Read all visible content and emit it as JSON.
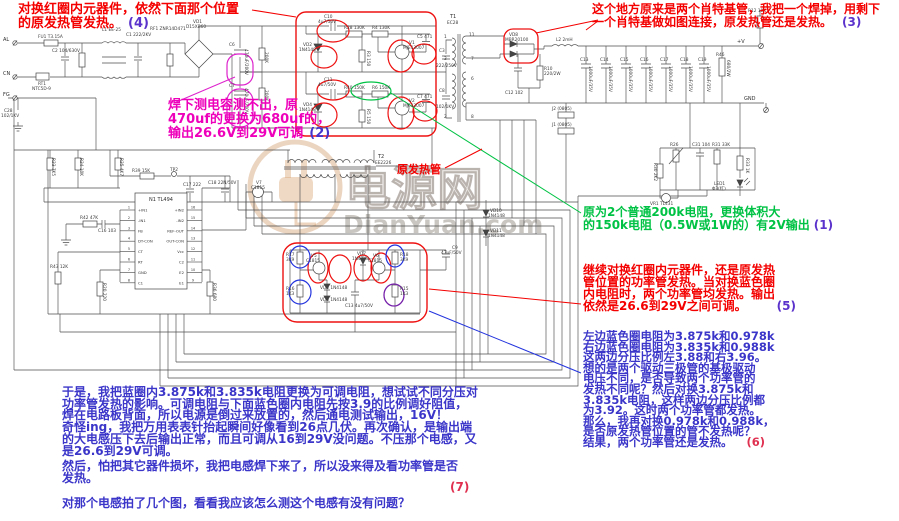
{
  "watermark": {
    "cn": "电源网",
    "en": "DianYuan.com"
  },
  "colors": {
    "annotation_red": "#f40000",
    "annotation_magenta": "#ee00bb",
    "annotation_green": "#00c244",
    "annotation_blue": "#3b36c9",
    "number_violet": "#5b33cc",
    "number_red": "#e03050",
    "highlight_red": "#ee1111",
    "highlight_magenta": "#dd22cc",
    "highlight_green": "#00c244",
    "highlight_blue": "#2233dd",
    "highlight_purple": "#7722aa"
  },
  "annotations": [
    {
      "id": "annotation-4",
      "x": 18,
      "y": 3,
      "c": "#f40000",
      "fs": 13,
      "lh": 13.5,
      "lines": [
        "对换红圈内元器件，依然下面那个位置",
        "的原发热管发热。"
      ],
      "num": "(4)",
      "nc": "#5b33cc",
      "gap": 6
    },
    {
      "id": "annotation-3",
      "x": 592,
      "y": 3,
      "c": "#f40000",
      "fs": 12,
      "lh": 13,
      "lines": [
        "这个地方原来是两个肖特基管，我把一个焊掉，用剩下",
        "一个肖特基做如图连接，原发热管还是发热。"
      ],
      "num": "(3)",
      "nc": "#5b33cc",
      "gap": 10
    },
    {
      "id": "annotation-2",
      "x": 168,
      "y": 99,
      "c": "#ee00bb",
      "fs": 13,
      "lh": 14,
      "lines": [
        "焊下测电容测不出，原",
        "470uf的更换为680uf的，",
        "输出26.6V到29V可调"
      ],
      "num": "(2)",
      "nc": "#4433cc",
      "gap": 6
    },
    {
      "id": "annotation-1",
      "x": 583,
      "y": 206,
      "c": "#00c244",
      "fs": 12,
      "lh": 12.5,
      "lines": [
        "原为2个普通200k电阻，更换体积大",
        "的150k电阻（0.5W或1W的）有2V输出"
      ],
      "num": "(1)",
      "nc": "#5b33cc",
      "gap": 4
    },
    {
      "id": "annotation-5",
      "x": 583,
      "y": 264,
      "c": "#f40000",
      "fs": 12,
      "lh": 12,
      "lines": [
        "继续对换红圈内元器件，还是原发热",
        "管位置的功率管发热。当对换蓝色圈",
        "内电阻时，两个功率管均发热。输出",
        "依然是26.6到29V之间可调。"
      ],
      "num": "(5)",
      "nc": "#5b33cc",
      "gap": 30
    },
    {
      "id": "annotation-6",
      "x": 583,
      "y": 331,
      "c": "#3b36c9",
      "fs": 11.5,
      "lh": 10.6,
      "lines": [
        "左边蓝色圈电阻为3.875k和0.978k",
        "右边蓝色圈电阻为3.835k和0.988k",
        "这两边分压比例左3.88和右3.96。",
        "想的是两个驱动三极管的基极驱动",
        "电压不同，是否导致两个功率管的",
        "发热不同呢？然后对换3.875k和",
        "3.835k电阻，这样两边分压比例都",
        "为3.92。这时两个功率管都发热。",
        "那么，我再对换0.978k和0.988k，",
        "是否原发热管位置的管不发热呢？",
        "结果，两个功率管还是发热。"
      ],
      "num": "(6)",
      "nc": "#e03050",
      "gap": 14
    },
    {
      "id": "annotation-hot-tube",
      "x": 397,
      "y": 164,
      "c": "#f40000",
      "fs": 11,
      "lh": 11,
      "lines": [
        "原发热管"
      ]
    },
    {
      "id": "annotation-story",
      "x": 62,
      "y": 387,
      "c": "#3b36c9",
      "fs": 12,
      "lh": 11.7,
      "l****ines": [],
      "lines": [
        "于是，我把蓝圈内3.875k和3.835k电阻更换为可调电阻，想试试不同分压对",
        "功率管发热的影响。可调电阻与下面蓝色圈内电阻先按3.9的比例调好阻值，",
        "焊在电路板背面，所以电源是倒过来放置的，然后通电测试输出，16V！",
        "奇怪ing，我把万用表表针抬起瞬间好像看到26点几伏。再次确认，是输出端",
        "的大电感压下去后输出正常，而且可调从16到29V没问题。不压那个电感，又",
        "是26.6到29V可调。"
      ]
    },
    {
      "id": "annotation-then",
      "x": 62,
      "y": 461,
      "c": "#3b36c9",
      "fs": 12,
      "lh": 11.7,
      "lines": [
        "然后，怕把其它器件损坏，我把电感焊下来了，所以没来得及看功率管是否",
        "发热。"
      ]
    },
    {
      "id": "annotation-7-number",
      "x": 450,
      "y": 481,
      "c": "#e03050",
      "fs": 12,
      "lh": 12,
      "lines": [
        "(7)"
      ]
    },
    {
      "id": "annotation-question",
      "x": 62,
      "y": 497,
      "c": "#3b36c9",
      "fs": 12,
      "lh": 12,
      "lines": [
        "对那个电感拍了几个图，看看我应该怎么测这个电感有没有问题？"
      ]
    }
  ],
  "ic": {
    "name": "N1",
    "part": "TL494",
    "pins_left": [
      {
        "n": "1",
        "label": "+IN1"
      },
      {
        "n": "2",
        "label": "-IN1"
      },
      {
        "n": "3",
        "label": "FB"
      },
      {
        "n": "4",
        "label": "DT-CON"
      },
      {
        "n": "5",
        "label": "CT"
      },
      {
        "n": "6",
        "label": "RT"
      },
      {
        "n": "7",
        "label": "GND"
      },
      {
        "n": "8",
        "label": "C1"
      }
    ],
    "pins_right": [
      {
        "n": "16",
        "label": "+IN2"
      },
      {
        "n": "15",
        "label": "-IN2"
      },
      {
        "n": "14",
        "label": "REF-OUT"
      },
      {
        "n": "13",
        "label": "OUT-CON"
      },
      {
        "n": "12",
        "label": "Vcc"
      },
      {
        "n": "11",
        "label": "C2"
      },
      {
        "n": "10",
        "label": "E2"
      },
      {
        "n": "9",
        "label": "E1"
      }
    ]
  },
  "schematic_labels": [
    {
      "t": "AL",
      "x": 3,
      "y": 41,
      "s": "b"
    },
    {
      "t": "CN",
      "x": 3,
      "y": 75,
      "s": "b"
    },
    {
      "t": "FG",
      "x": 3,
      "y": 96,
      "s": "b"
    },
    {
      "t": "FU1 T3.15A",
      "x": 38,
      "y": 38
    },
    {
      "t": "L1 EE-25",
      "x": 102,
      "y": 31
    },
    {
      "t": "C1 222/2KV",
      "x": 126,
      "y": 36
    },
    {
      "t": "RF1 ZNR14D471",
      "x": 150,
      "y": 30
    },
    {
      "t": "VD1",
      "x": 193,
      "y": 23
    },
    {
      "t": "D15XB60",
      "x": 186,
      "y": 28
    },
    {
      "t": "RT1",
      "x": 38,
      "y": 85
    },
    {
      "t": "NTC5D-9",
      "x": 32,
      "y": 90
    },
    {
      "t": "C2 104/630V",
      "x": 52,
      "y": 52
    },
    {
      "t": "C28",
      "x": 4,
      "y": 112
    },
    {
      "t": "102/1KV",
      "x": 1,
      "y": 117
    },
    {
      "t": "C6",
      "x": 229,
      "y": 46
    },
    {
      "t": "470uF/200V",
      "x": 245,
      "y": 49,
      "r": 90
    },
    {
      "t": "C7",
      "x": 229,
      "y": 87
    },
    {
      "t": "470uF/200V",
      "x": 245,
      "y": 88,
      "r": 90
    },
    {
      "t": "200K",
      "x": 265,
      "y": 52,
      "r": 90
    },
    {
      "t": "200K",
      "x": 265,
      "y": 90,
      "r": 90
    },
    {
      "t": "C10",
      "x": 324,
      "y": 18
    },
    {
      "t": "4u7/50V",
      "x": 318,
      "y": 23
    },
    {
      "t": "R28 130K",
      "x": 344,
      "y": 29
    },
    {
      "t": "R4 130K",
      "x": 372,
      "y": 29
    },
    {
      "t": "VD2",
      "x": 303,
      "y": 46
    },
    {
      "t": "1N4148",
      "x": 299,
      "y": 51
    },
    {
      "t": "R3 150",
      "x": 367,
      "y": 51,
      "r": 90
    },
    {
      "t": "V1",
      "x": 409,
      "y": 44
    },
    {
      "t": "MJE13007",
      "x": 403,
      "y": 49
    },
    {
      "t": "C5 471",
      "x": 417,
      "y": 38
    },
    {
      "t": "C11",
      "x": 324,
      "y": 81
    },
    {
      "t": "4u7/50V",
      "x": 318,
      "y": 86
    },
    {
      "t": "R40 150K",
      "x": 344,
      "y": 89
    },
    {
      "t": "R6 150K",
      "x": 372,
      "y": 89
    },
    {
      "t": "VD4",
      "x": 303,
      "y": 106
    },
    {
      "t": "1N4148",
      "x": 299,
      "y": 111
    },
    {
      "t": "R5 150",
      "x": 367,
      "y": 109,
      "r": 90
    },
    {
      "t": "V2",
      "x": 409,
      "y": 102
    },
    {
      "t": "MJE13007",
      "x": 403,
      "y": 107
    },
    {
      "t": "C7 471",
      "x": 417,
      "y": 98
    },
    {
      "t": "C3",
      "x": 439,
      "y": 52
    },
    {
      "t": "222/250V",
      "x": 436,
      "y": 67
    },
    {
      "t": "C8",
      "x": 439,
      "y": 92
    },
    {
      "t": "102/1KV",
      "x": 436,
      "y": 108
    },
    {
      "t": "T1",
      "x": 450,
      "y": 18,
      "s": "b"
    },
    {
      "t": "EC28",
      "x": 447,
      "y": 24
    },
    {
      "t": "1",
      "x": 444,
      "y": 38
    },
    {
      "t": "3",
      "x": 444,
      "y": 60
    },
    {
      "t": "2",
      "x": 444,
      "y": 118
    },
    {
      "t": "11",
      "x": 469,
      "y": 36
    },
    {
      "t": "7",
      "x": 471,
      "y": 60
    },
    {
      "t": "6",
      "x": 471,
      "y": 80
    },
    {
      "t": "8",
      "x": 471,
      "y": 118
    },
    {
      "t": "VD8",
      "x": 509,
      "y": 36
    },
    {
      "t": "MBR20100",
      "x": 505,
      "y": 41
    },
    {
      "t": "L2 2mH",
      "x": 556,
      "y": 41
    },
    {
      "t": "C12 102",
      "x": 505,
      "y": 94
    },
    {
      "t": "R10",
      "x": 544,
      "y": 70
    },
    {
      "t": "220/2W",
      "x": 544,
      "y": 75
    },
    {
      "t": "C13",
      "x": 580,
      "y": 61
    },
    {
      "t": "1000uF/35V",
      "x": 589,
      "y": 66,
      "r": 90
    },
    {
      "t": "C14",
      "x": 600,
      "y": 61
    },
    {
      "t": "1000uF/35V",
      "x": 609,
      "y": 66,
      "r": 90
    },
    {
      "t": "C15",
      "x": 620,
      "y": 61
    },
    {
      "t": "1000uF/35V",
      "x": 629,
      "y": 66,
      "r": 90
    },
    {
      "t": "C16",
      "x": 640,
      "y": 61
    },
    {
      "t": "1000uF/35V",
      "x": 649,
      "y": 66,
      "r": 90
    },
    {
      "t": "C17",
      "x": 660,
      "y": 61
    },
    {
      "t": "1000uF/35V",
      "x": 669,
      "y": 66,
      "r": 90
    },
    {
      "t": "C18",
      "x": 680,
      "y": 61
    },
    {
      "t": "1000uF/35V",
      "x": 689,
      "y": 66,
      "r": 90
    },
    {
      "t": "C19",
      "x": 698,
      "y": 61
    },
    {
      "t": "1000uF/35V",
      "x": 707,
      "y": 66,
      "r": 90
    },
    {
      "t": "R46",
      "x": 716,
      "y": 56
    },
    {
      "t": "680/2W",
      "x": 727,
      "y": 60,
      "r": 90
    },
    {
      "t": "R12 10K",
      "x": 748,
      "y": 12
    },
    {
      "t": "+V",
      "x": 737,
      "y": 43,
      "s": "b"
    },
    {
      "t": "GND",
      "x": 744,
      "y": 100,
      "s": "b"
    },
    {
      "t": "J2 (0805)",
      "x": 552,
      "y": 110
    },
    {
      "t": "J1 (0805)",
      "x": 552,
      "y": 126
    },
    {
      "t": "R26",
      "x": 670,
      "y": 146
    },
    {
      "t": "C31 104",
      "x": 692,
      "y": 146
    },
    {
      "t": "R31 33K",
      "x": 712,
      "y": 146
    },
    {
      "t": "R30 2K2",
      "x": 654,
      "y": 163,
      "r": 90
    },
    {
      "t": "R33 1K",
      "x": 746,
      "y": 158,
      "r": 90
    },
    {
      "t": "LED1",
      "x": 714,
      "y": 185
    },
    {
      "t": "Φ3(红)",
      "x": 712,
      "y": 190
    },
    {
      "t": "VR1 TL431",
      "x": 650,
      "y": 205
    },
    {
      "t": "R39 15K",
      "x": 132,
      "y": 172
    },
    {
      "t": "TP2",
      "x": 170,
      "y": 171
    },
    {
      "t": "C17 222",
      "x": 183,
      "y": 186
    },
    {
      "t": "C18 22N/50V",
      "x": 208,
      "y": 184
    },
    {
      "t": "V7",
      "x": 256,
      "y": 184
    },
    {
      "t": "C1815",
      "x": 251,
      "y": 189
    },
    {
      "t": "R23 7K5",
      "x": 52,
      "y": 158,
      "r": 90
    },
    {
      "t": "R24 10K",
      "x": 80,
      "y": 158,
      "r": 90
    },
    {
      "t": "R25 4K7",
      "x": 120,
      "y": 158,
      "r": 90
    },
    {
      "t": "R42 47K",
      "x": 80,
      "y": 219
    },
    {
      "t": "C16 103",
      "x": 98,
      "y": 232
    },
    {
      "t": "R43 12K",
      "x": 50,
      "y": 268
    },
    {
      "t": "R20 220",
      "x": 103,
      "y": 283,
      "r": 90
    },
    {
      "t": "R36 680",
      "x": 213,
      "y": 283,
      "r": 90
    },
    {
      "t": "T2",
      "x": 378,
      "y": 158,
      "s": "b"
    },
    {
      "t": "EE2226",
      "x": 375,
      "y": 164
    },
    {
      "t": "R17",
      "x": 286,
      "y": 256
    },
    {
      "t": "3K9",
      "x": 286,
      "y": 261
    },
    {
      "t": "R16",
      "x": 286,
      "y": 290
    },
    {
      "t": "1K3",
      "x": 286,
      "y": 295
    },
    {
      "t": "R18",
      "x": 400,
      "y": 256
    },
    {
      "t": "3K9",
      "x": 400,
      "y": 261
    },
    {
      "t": "R15",
      "x": 400,
      "y": 290
    },
    {
      "t": "1K3",
      "x": 400,
      "y": 295
    },
    {
      "t": "V5",
      "x": 311,
      "y": 257
    },
    {
      "t": "C1815",
      "x": 306,
      "y": 262
    },
    {
      "t": "V6",
      "x": 373,
      "y": 257
    },
    {
      "t": "C1815",
      "x": 368,
      "y": 262
    },
    {
      "t": "VD7",
      "x": 357,
      "y": 255
    },
    {
      "t": "1N4148",
      "x": 352,
      "y": 260
    },
    {
      "t": "VD5 1N4148",
      "x": 320,
      "y": 289
    },
    {
      "t": "VD6 1N4148",
      "x": 320,
      "y": 301
    },
    {
      "t": "C13 4u7/50V",
      "x": 345,
      "y": 307
    },
    {
      "t": "C9",
      "x": 452,
      "y": 249
    },
    {
      "t": "47uF/50V",
      "x": 441,
      "y": 254
    },
    {
      "t": "VD10",
      "x": 490,
      "y": 212
    },
    {
      "t": "1N4148",
      "x": 488,
      "y": 217
    },
    {
      "t": "VD11",
      "x": 490,
      "y": 232
    },
    {
      "t": "1N4148",
      "x": 488,
      "y": 237
    }
  ]
}
